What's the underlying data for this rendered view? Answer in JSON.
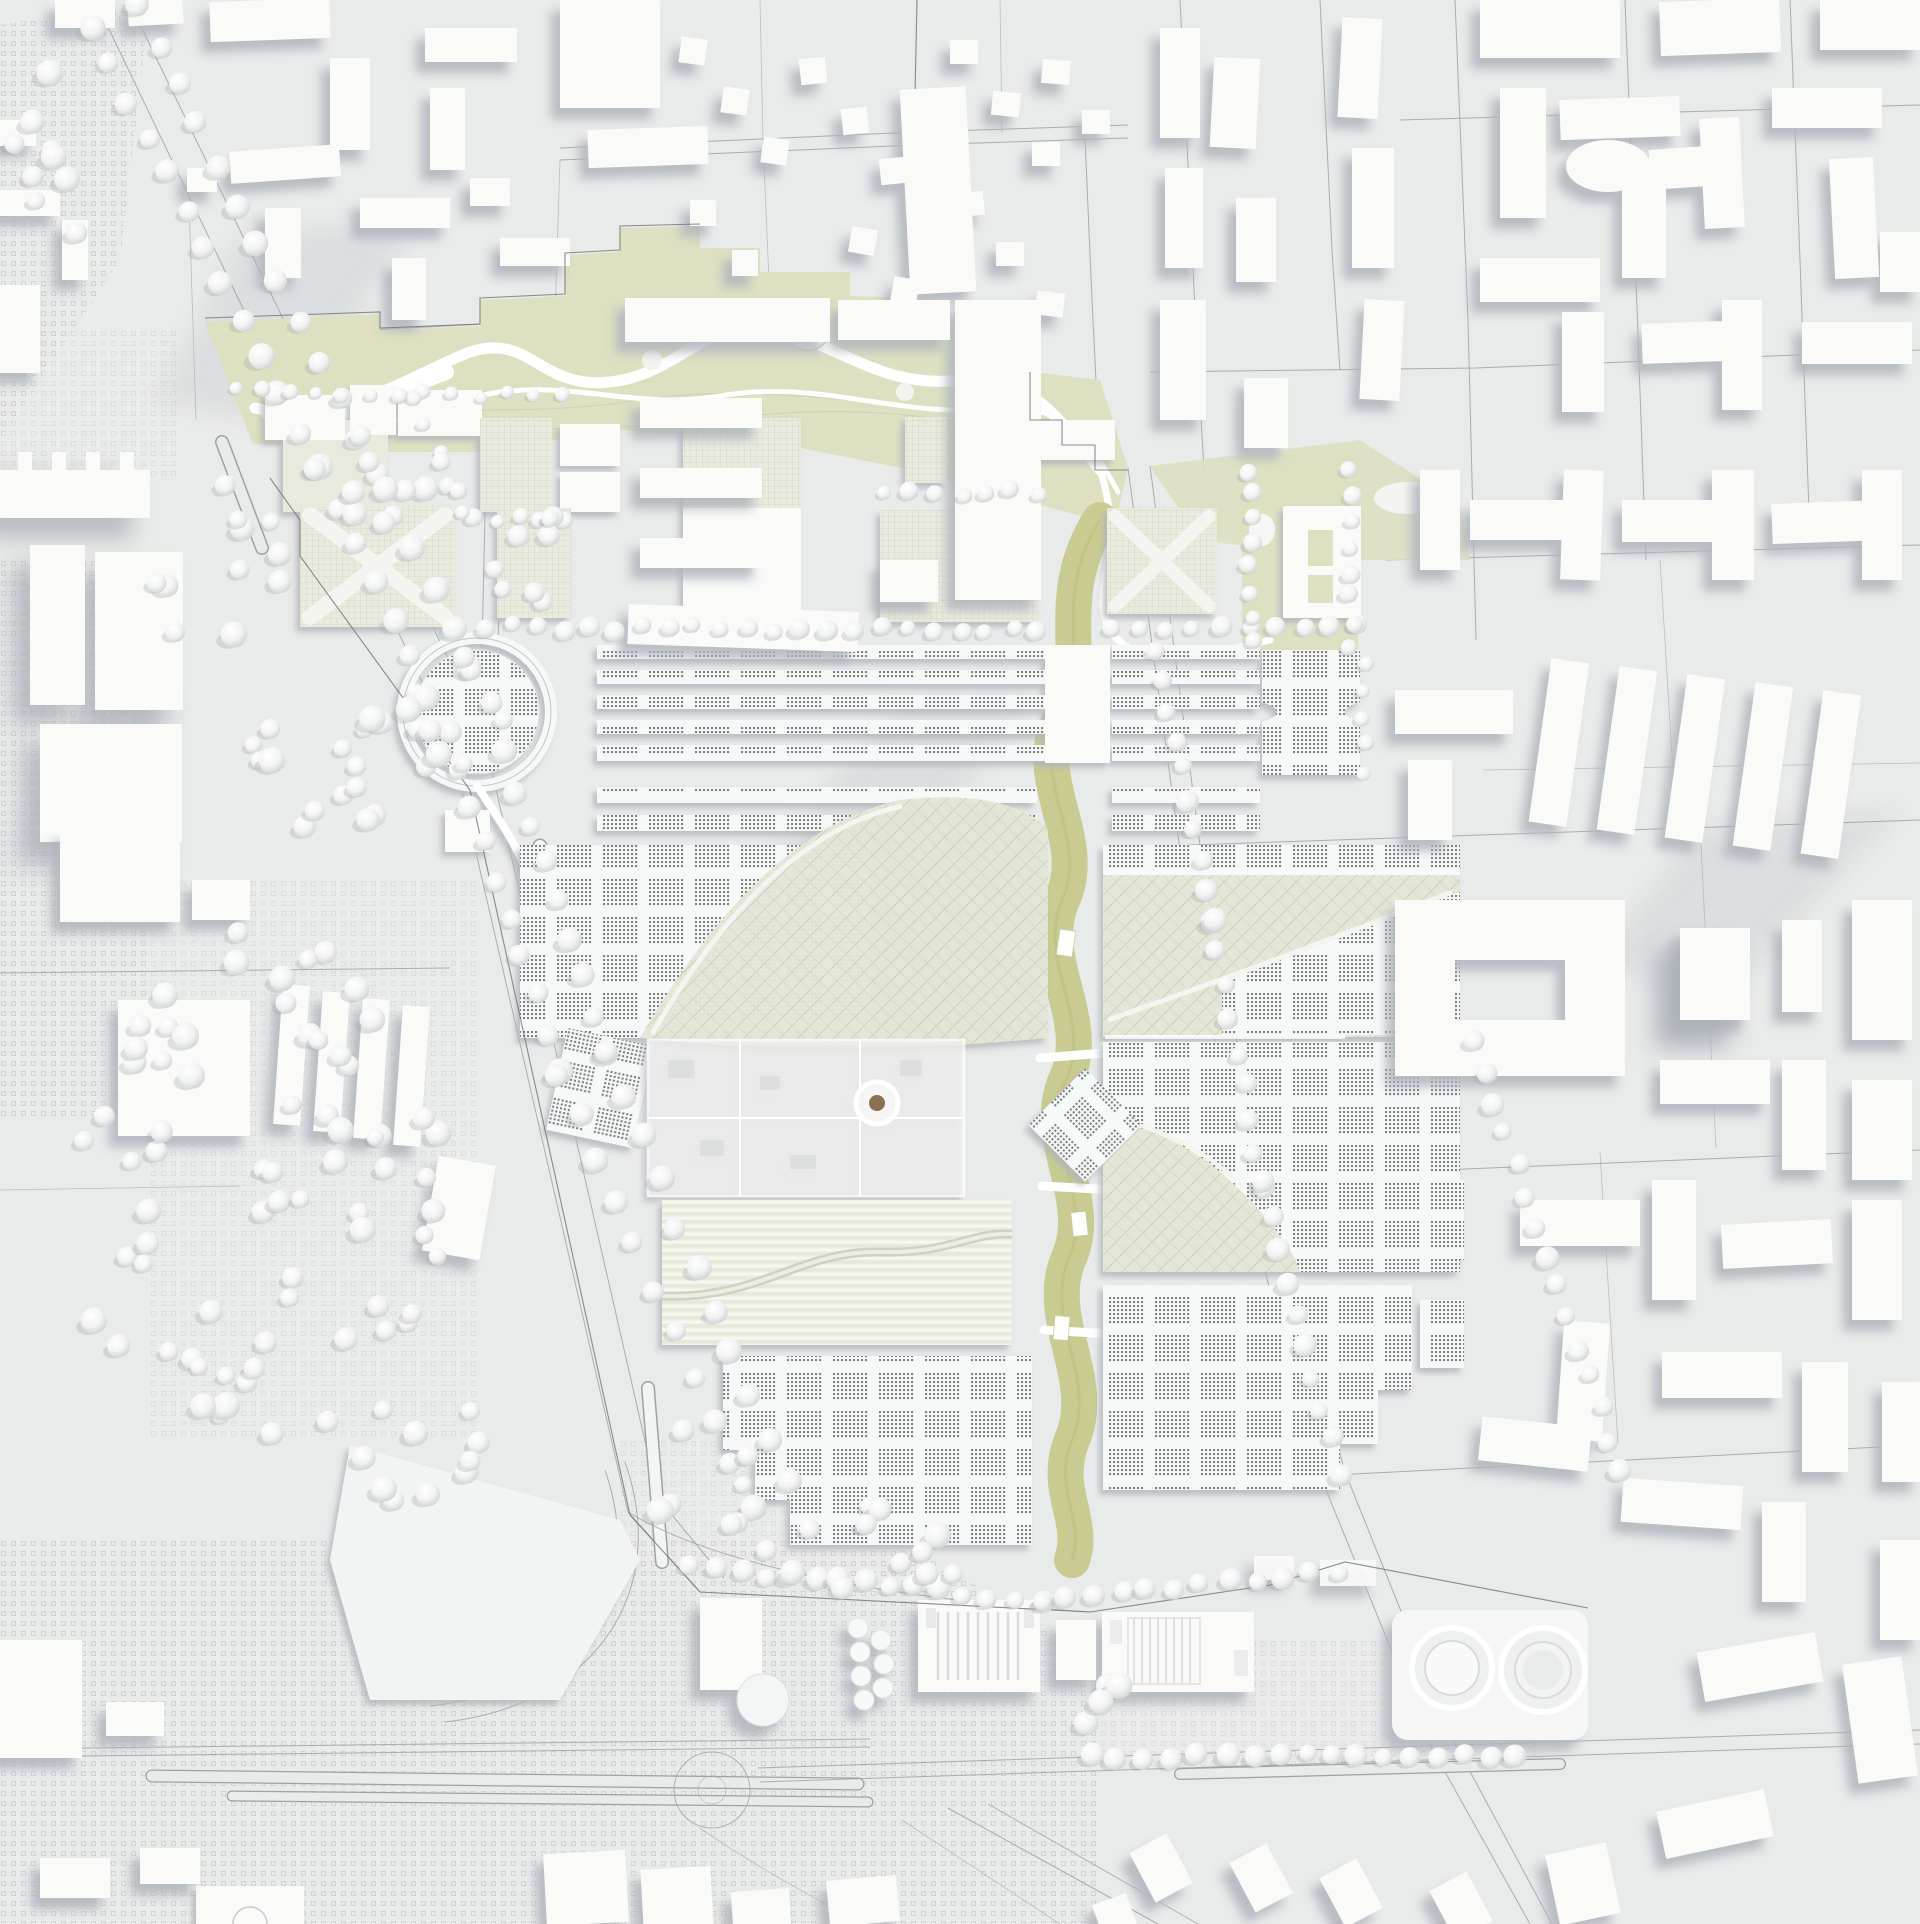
{
  "palette": {
    "base": "#e9eaea",
    "base_light": "#f1f2f2",
    "building": "#fafaf9",
    "building_tall": "#f5f6f6",
    "shadow": "#b7bbc1",
    "road_line": "#a0a2a4",
    "stipple": "#c3c4c5",
    "green_park": "#dde0c1",
    "green_band": "#c8cc90",
    "green_soft": "#e9eadf",
    "quilt": "#e4e6d7",
    "perf_dot": "#7e8083",
    "tree_edge": "#cfd2d4",
    "dome_center": "#8a6f55"
  },
  "scene": {
    "tree_rows": [
      {
        "x1": 92,
        "y1": 28,
        "x2": 318,
        "y2": 468,
        "n": 13,
        "s": 11
      },
      {
        "x1": 138,
        "y1": 8,
        "x2": 358,
        "y2": 438,
        "n": 12,
        "s": 11
      },
      {
        "x1": 318,
        "y1": 468,
        "x2": 452,
        "y2": 732,
        "n": 8,
        "s": 11
      },
      {
        "x1": 358,
        "y1": 438,
        "x2": 492,
        "y2": 702,
        "n": 8,
        "s": 11
      },
      {
        "x1": 458,
        "y1": 768,
        "x2": 560,
        "y2": 1072,
        "n": 9,
        "s": 11
      },
      {
        "x1": 506,
        "y1": 752,
        "x2": 604,
        "y2": 1052,
        "n": 9,
        "s": 11
      },
      {
        "x1": 560,
        "y1": 1072,
        "x2": 768,
        "y2": 1548,
        "n": 12,
        "s": 11
      },
      {
        "x1": 604,
        "y1": 1052,
        "x2": 806,
        "y2": 1528,
        "n": 12,
        "s": 11
      },
      {
        "x1": 236,
        "y1": 392,
        "x2": 560,
        "y2": 396,
        "n": 13,
        "s": 7
      },
      {
        "x1": 886,
        "y1": 492,
        "x2": 1038,
        "y2": 492,
        "n": 7,
        "s": 8
      },
      {
        "x1": 470,
        "y1": 520,
        "x2": 565,
        "y2": 520,
        "n": 5,
        "s": 8
      },
      {
        "x1": 484,
        "y1": 627,
        "x2": 1040,
        "y2": 630,
        "n": 22,
        "s": 9
      },
      {
        "x1": 1112,
        "y1": 630,
        "x2": 1358,
        "y2": 627,
        "n": 10,
        "s": 9
      },
      {
        "x1": 1158,
        "y1": 648,
        "x2": 1212,
        "y2": 920,
        "n": 10,
        "s": 10
      },
      {
        "x1": 1212,
        "y1": 920,
        "x2": 1262,
        "y2": 1185,
        "n": 9,
        "s": 10
      },
      {
        "x1": 1262,
        "y1": 1185,
        "x2": 1338,
        "y2": 1472,
        "n": 10,
        "s": 10
      },
      {
        "x1": 1475,
        "y1": 1040,
        "x2": 1622,
        "y2": 1470,
        "n": 15,
        "s": 10
      },
      {
        "x1": 692,
        "y1": 1568,
        "x2": 1040,
        "y2": 1600,
        "n": 15,
        "s": 10
      },
      {
        "x1": 1040,
        "y1": 1600,
        "x2": 1338,
        "y2": 1572,
        "n": 12,
        "s": 10
      },
      {
        "x1": 1092,
        "y1": 1756,
        "x2": 1518,
        "y2": 1758,
        "n": 17,
        "s": 10
      },
      {
        "x1": 1250,
        "y1": 470,
        "x2": 1250,
        "y2": 642,
        "n": 8,
        "s": 8
      },
      {
        "x1": 1352,
        "y1": 470,
        "x2": 1352,
        "y2": 648,
        "n": 8,
        "s": 8
      },
      {
        "x1": 1364,
        "y1": 660,
        "x2": 1364,
        "y2": 772,
        "n": 5,
        "s": 8
      },
      {
        "x1": 414,
        "y1": 398,
        "x2": 462,
        "y2": 512,
        "n": 5,
        "s": 8
      }
    ],
    "tree_clusters": [
      {
        "cx": 250,
        "cy": 1190,
        "rx": 195,
        "ry": 265,
        "n": 72,
        "seed": 3
      },
      {
        "cx": 330,
        "cy": 770,
        "rx": 95,
        "ry": 75,
        "n": 15,
        "seed": 5
      },
      {
        "cx": 215,
        "cy": 565,
        "rx": 70,
        "ry": 85,
        "n": 11,
        "seed": 7
      },
      {
        "cx": 62,
        "cy": 150,
        "rx": 55,
        "ry": 95,
        "n": 9,
        "seed": 9
      },
      {
        "cx": 395,
        "cy": 492,
        "rx": 75,
        "ry": 45,
        "n": 9,
        "seed": 11
      },
      {
        "cx": 452,
        "cy": 712,
        "rx": 60,
        "ry": 80,
        "n": 12,
        "seed": 13
      },
      {
        "cx": 875,
        "cy": 1552,
        "rx": 110,
        "ry": 48,
        "n": 11,
        "seed": 15
      },
      {
        "cx": 705,
        "cy": 1476,
        "rx": 62,
        "ry": 55,
        "n": 8,
        "seed": 17
      },
      {
        "cx": 428,
        "cy": 1452,
        "rx": 85,
        "ry": 60,
        "n": 10,
        "seed": 19
      },
      {
        "cx": 1102,
        "cy": 1698,
        "rx": 40,
        "ry": 30,
        "n": 5,
        "seed": 21
      },
      {
        "cx": 540,
        "cy": 560,
        "rx": 55,
        "ry": 45,
        "n": 8,
        "seed": 23
      }
    ]
  }
}
